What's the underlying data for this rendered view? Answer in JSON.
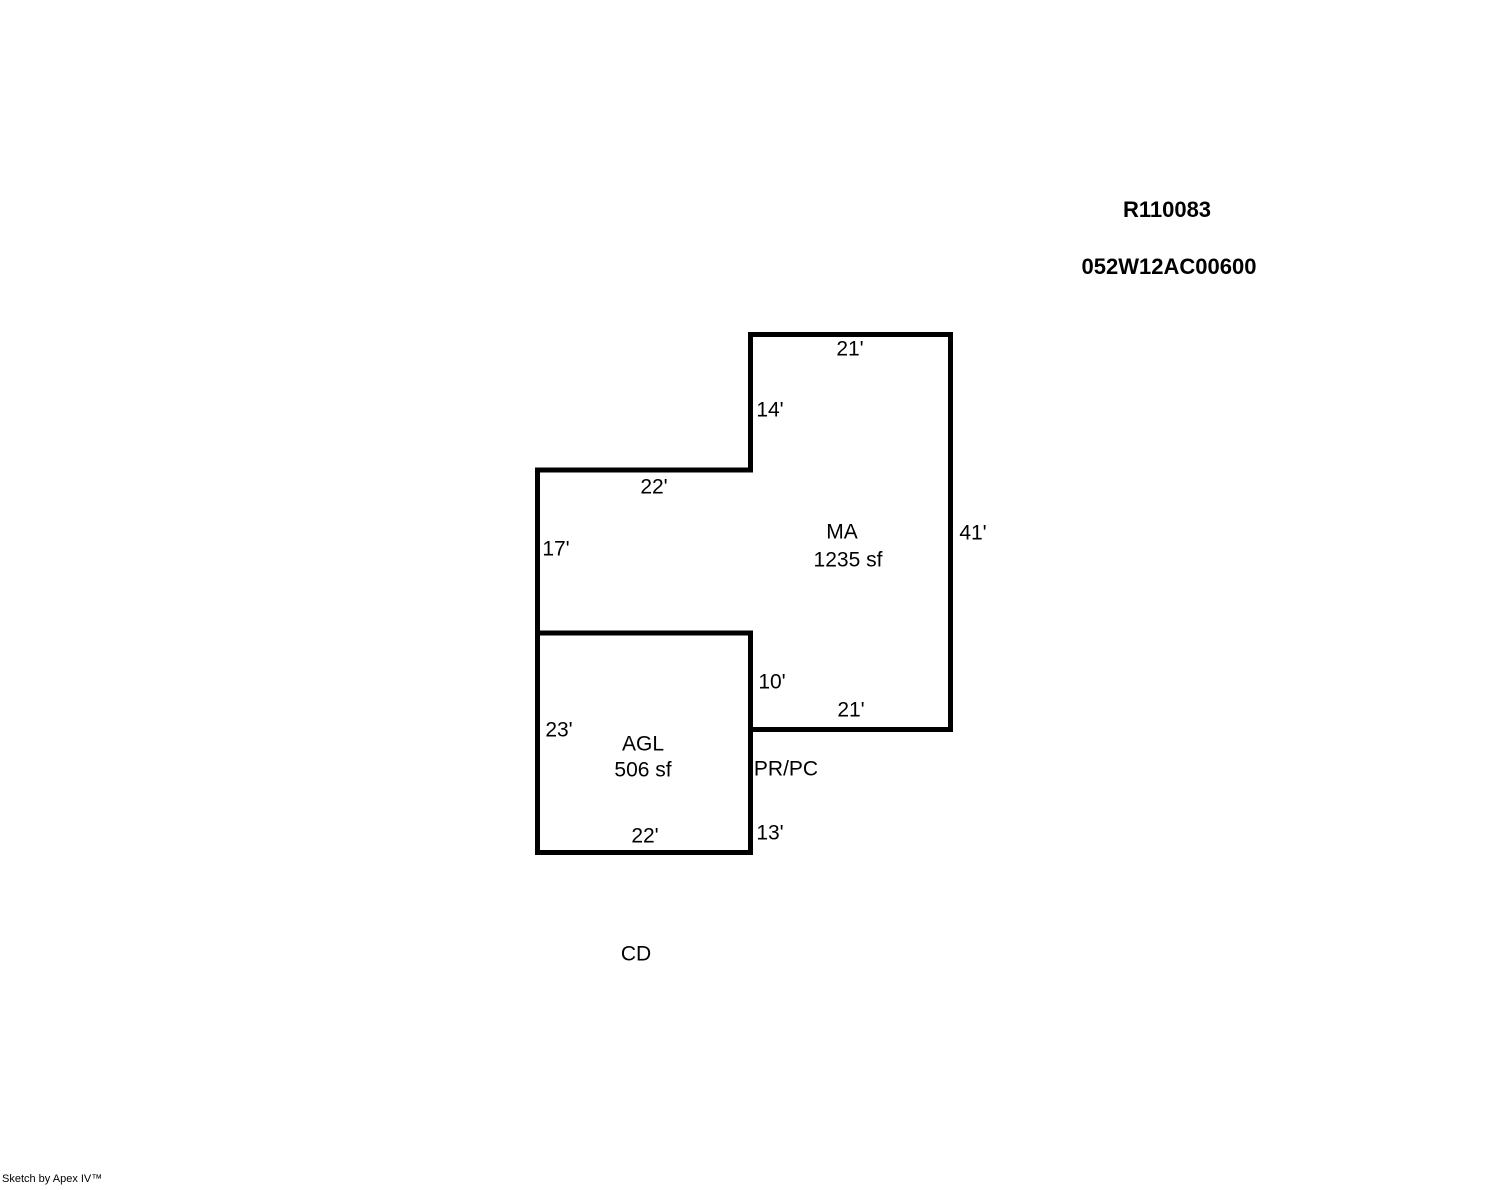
{
  "document": {
    "record_id": "R110083",
    "parcel_id": "052W12AC00600",
    "footer_credit": "Sketch by Apex IV™"
  },
  "sketch": {
    "background": "#ffffff",
    "line_color": "#000000",
    "areas": {
      "ma": {
        "code": "MA",
        "size": "1235 sf"
      },
      "agl": {
        "code": "AGL",
        "size": "506 sf"
      }
    },
    "annotations": {
      "pr_pc": "PR/PC",
      "cd": "CD"
    },
    "dimensions": {
      "ma_top_width": "21'",
      "ma_upper_left_height": "14'",
      "wing_top_width": "22'",
      "wing_left_height": "17'",
      "ma_right_height": "41'",
      "notch_height": "10'",
      "ma_bottom_width": "21'",
      "agl_left_height": "23'",
      "agl_right_height": "13'",
      "agl_bottom_width": "22'"
    }
  }
}
